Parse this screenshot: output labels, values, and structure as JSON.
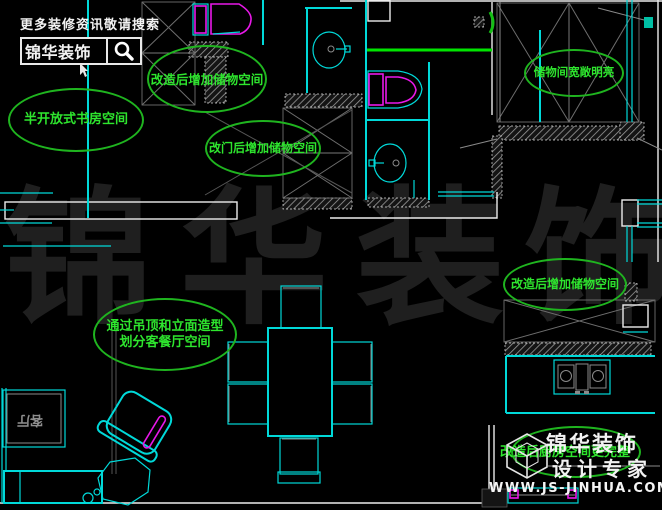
{
  "colors": {
    "background": "#000000",
    "plan_cyan": "#00d9d9",
    "plan_white": "#ececec",
    "annotation_green": "#2ee52e",
    "ellipse_green": "#1fb41f",
    "highlight_green": "#00e400",
    "fixture_magenta": "#e818e8",
    "watermark_gray": "#1f1f1f"
  },
  "banner": {
    "tagline": "更多装修资讯敬请搜索",
    "brand": "锦华装饰",
    "icon": "magnifier-icon"
  },
  "watermark": {
    "char1": "锦",
    "char2": "华",
    "char3": "装",
    "char4": "饰"
  },
  "annotations": [
    {
      "text": "改造后增加储物空间"
    },
    {
      "text": "半开放式书房空间"
    },
    {
      "text": "改门后增加储物空间"
    },
    {
      "text": "储物间宽敞明亮"
    },
    {
      "text": "改造后增加储物空间"
    },
    {
      "line1": "通过吊顶和立面造型",
      "line2": "划分客餐厅空间"
    },
    {
      "text": "改造后厨房空间更完整"
    }
  ],
  "room_labels": {
    "living_room": "客厅"
  },
  "logo": {
    "brand": "锦华装饰",
    "subtitle": "设计专家",
    "website": "WWW.JS-JINHUA.COM",
    "icon": "cube-logo-icon"
  },
  "icons": {
    "search": "magnifier-icon",
    "logo": "cube-logo-icon",
    "cursor": "cursor-arrow-icon"
  }
}
